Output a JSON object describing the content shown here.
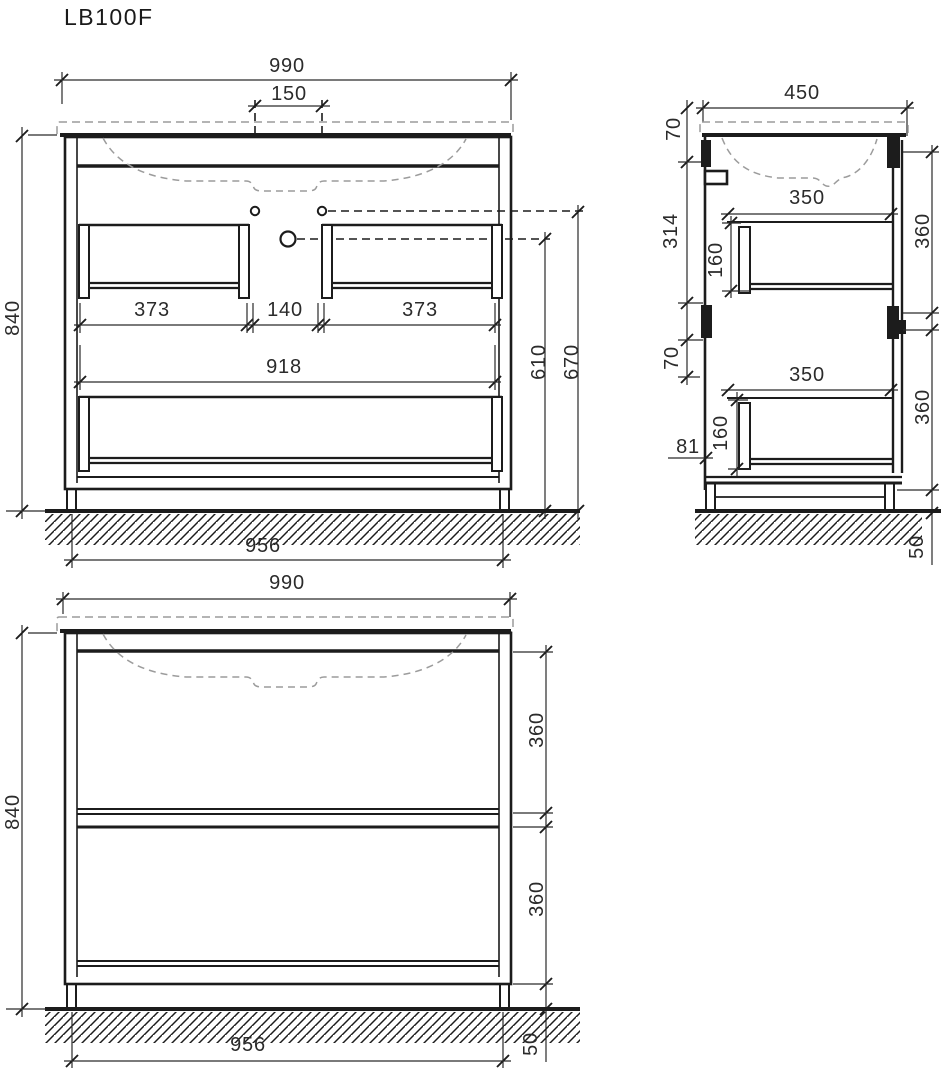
{
  "title": "LB100F",
  "front": {
    "overall_width": "990",
    "faucet_hole_spacing": "150",
    "overall_height": "840",
    "left_drawer_width": "373",
    "center_gap": "140",
    "right_drawer_width": "373",
    "interior_width": "918",
    "base_width": "956",
    "faucet_height": "610",
    "hole_height": "670"
  },
  "side": {
    "overall_depth": "450",
    "top_offset": "70",
    "upper_section_height": "314",
    "mid_offset": "70",
    "upper_drawer_depth": "350",
    "upper_drawer_height": "160",
    "lower_drawer_depth": "350",
    "lower_drawer_height": "160",
    "back_clearance": "81",
    "upper_front_height": "360",
    "lower_front_height": "360",
    "plinth_height": "50"
  },
  "bottom": {
    "overall_width": "990",
    "overall_height": "840",
    "upper_front_height": "360",
    "lower_front_height": "360",
    "plinth_height": "50",
    "base_width": "956"
  }
}
